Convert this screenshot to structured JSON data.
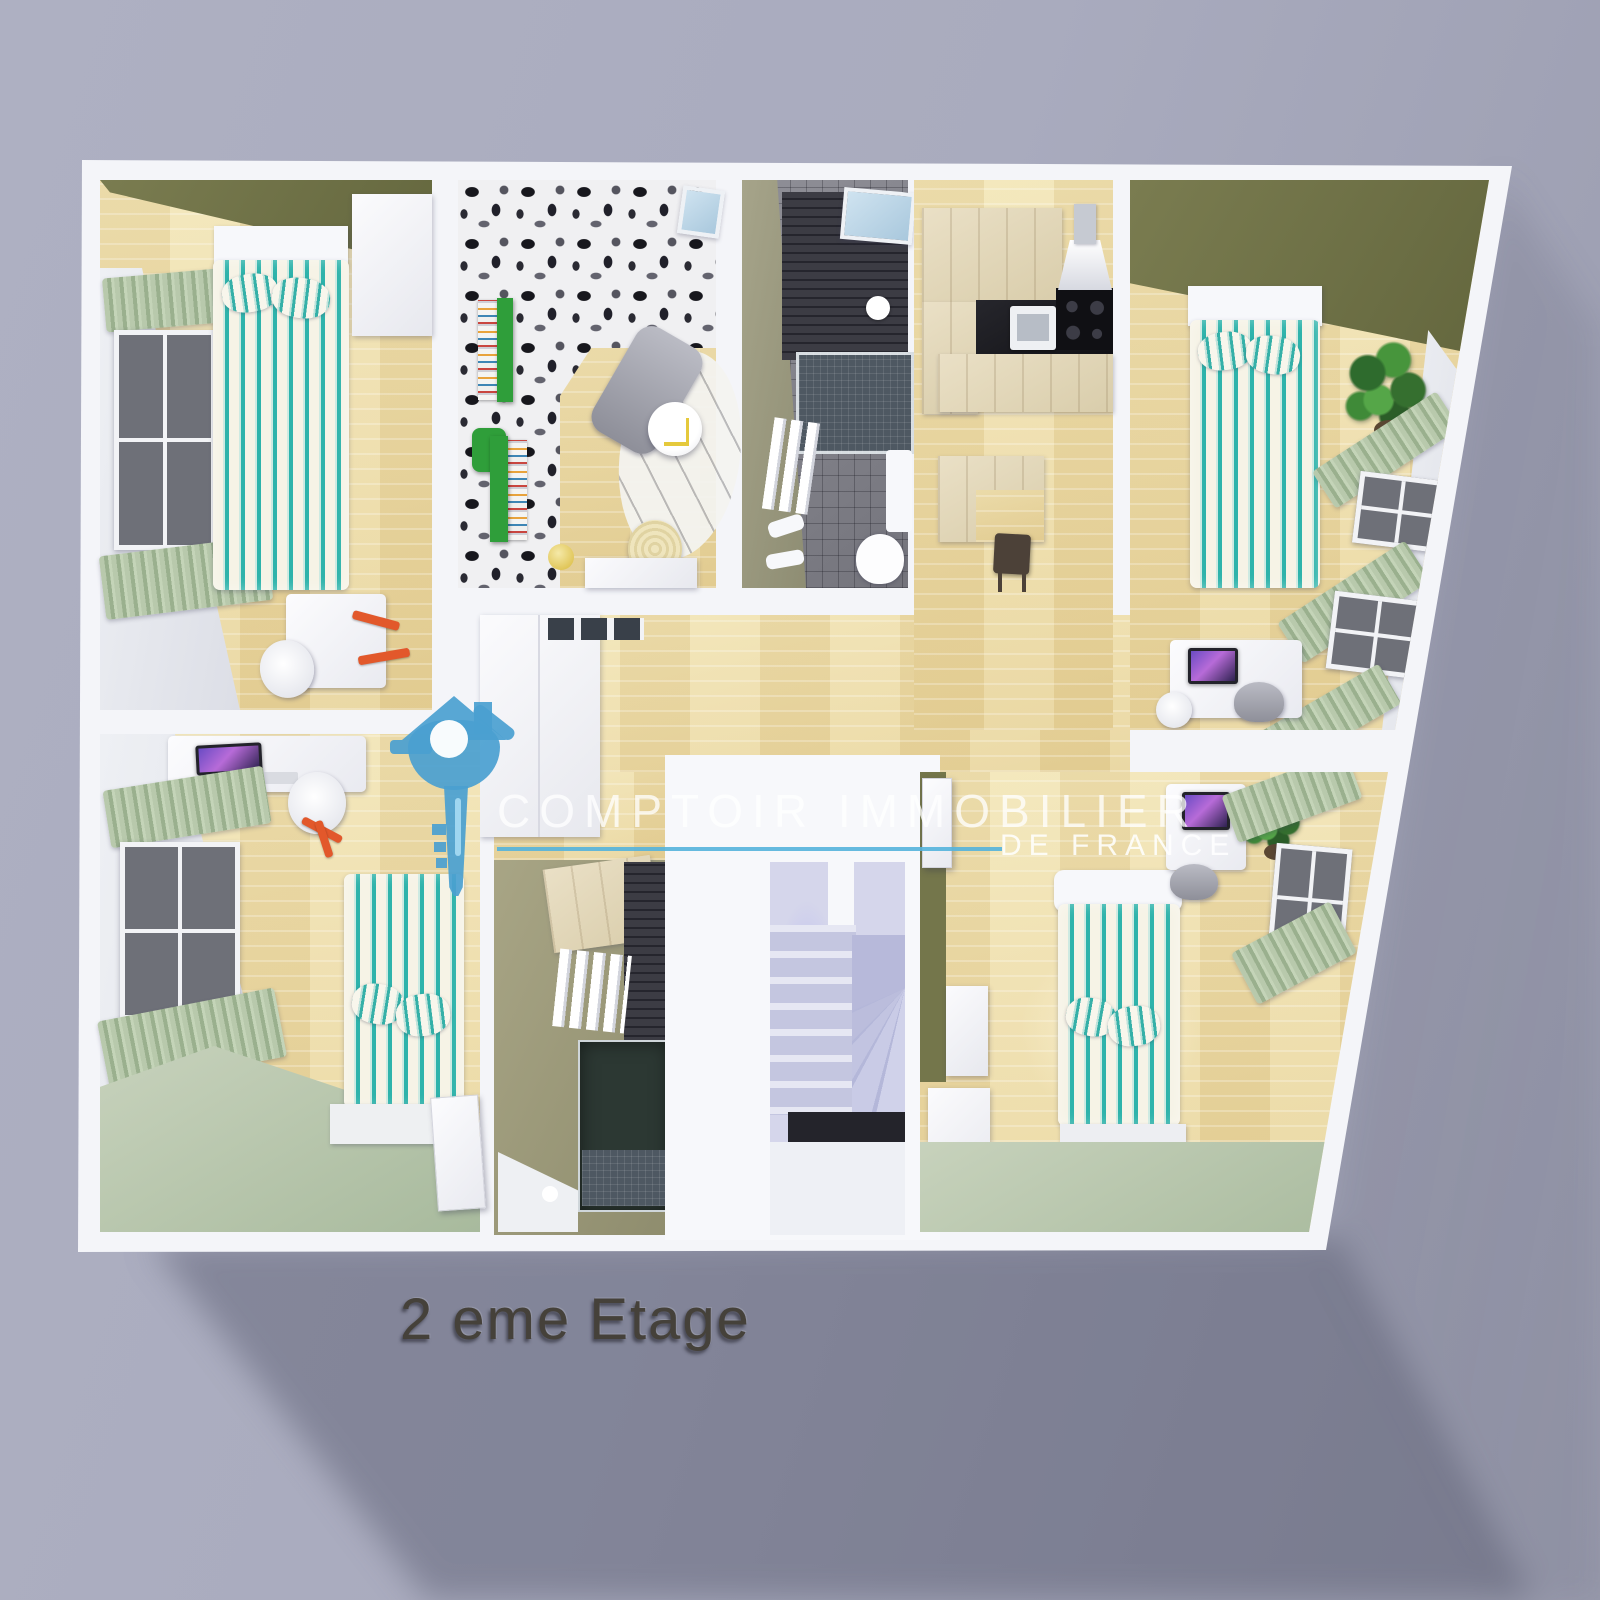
{
  "page": {
    "kind": "3d-floor-plan-render"
  },
  "watermark": {
    "brand": "COMPTOIR IMMOBILIER",
    "region": "DE FRANCE",
    "logo_icon": "house-key-icon",
    "accent_blue": "#4aa0d0",
    "underline_color": "#54b2dc",
    "text_color": "rgba(255,255,255,0.76)"
  },
  "caption": {
    "text": "2 eme Etage",
    "color": "#45413a"
  },
  "palette": {
    "background": "#a9abbe",
    "cast_shadow": "#8b8da1",
    "plan_surface": "#f4f5f9",
    "wood_floor": "#eddfa8",
    "sage_floor": "#b7c6ac",
    "olive_wall": "#6f7146",
    "bed_stripe_teal": "#2eb3ab",
    "curtain_green": "#a9bfa2",
    "stair_lavender": "#d3d4e9",
    "dark_shower_tile": "#36363e",
    "kitchen_counter": "#1d1d23",
    "logo_blue": "#4aa0d0"
  }
}
